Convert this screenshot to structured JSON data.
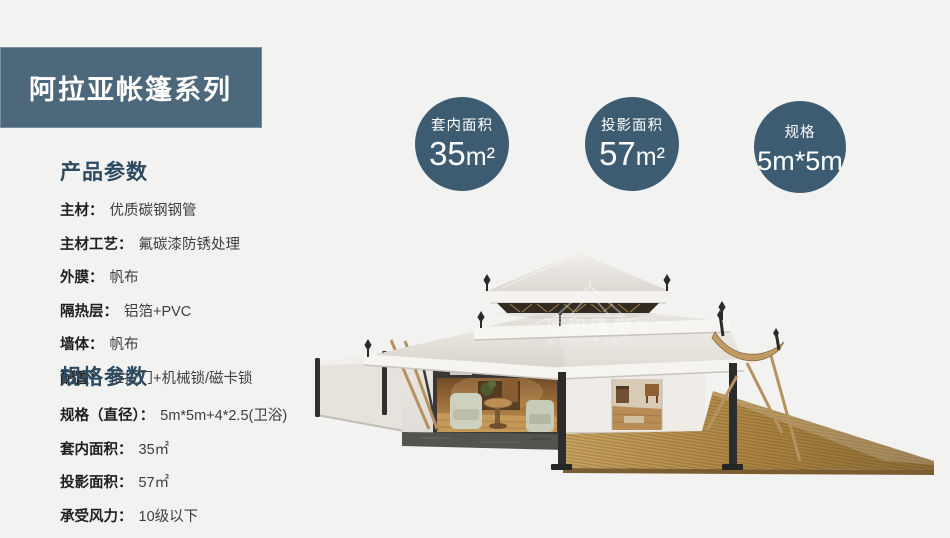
{
  "page": {
    "background": "#f2f2f1"
  },
  "banner": {
    "title": "阿拉亚帐篷系列"
  },
  "stat_circles": [
    {
      "label": "套内面积",
      "value": "35",
      "unit": "m²"
    },
    {
      "label": "投影面积",
      "value": "57",
      "unit": "m²"
    },
    {
      "label": "规格",
      "value": "5m*5m",
      "unit": ""
    }
  ],
  "product_params": {
    "heading": "产品参数",
    "rows": [
      {
        "label": "主材：",
        "value": "优质碳钢钢管"
      },
      {
        "label": "主材工艺：",
        "value": "氟碳漆防锈处理"
      },
      {
        "label": "外膜：",
        "value": "帆布"
      },
      {
        "label": "隔热层：",
        "value": "铝箔+PVC"
      },
      {
        "label": "墙体：",
        "value": "帆布"
      },
      {
        "label": "配置：",
        "value": "推拉门+机械锁/磁卡锁"
      }
    ]
  },
  "spec_params": {
    "heading": "规格参数",
    "rows": [
      {
        "label": "规格（直径）：",
        "value": "5m*5m+4*2.5(卫浴)"
      },
      {
        "label": "套内面积：",
        "value": "35㎡"
      },
      {
        "label": "投影面积：",
        "value": "57㎡"
      },
      {
        "label": "承受风力：",
        "value": "10级以下"
      }
    ]
  },
  "watermark": {
    "icon": "tent-outline-icon",
    "line1": "顶和篷房",
    "line2": "WELL TENT"
  },
  "colors": {
    "banner_bg": "#4d677b",
    "circle_bg": "#3d5c71",
    "heading": "#2d4b60",
    "roof_cream": "#ece9e4",
    "deck_wood": "#b28a4e",
    "canvas_tan": "#b5925f",
    "stone_base": "#555350"
  }
}
